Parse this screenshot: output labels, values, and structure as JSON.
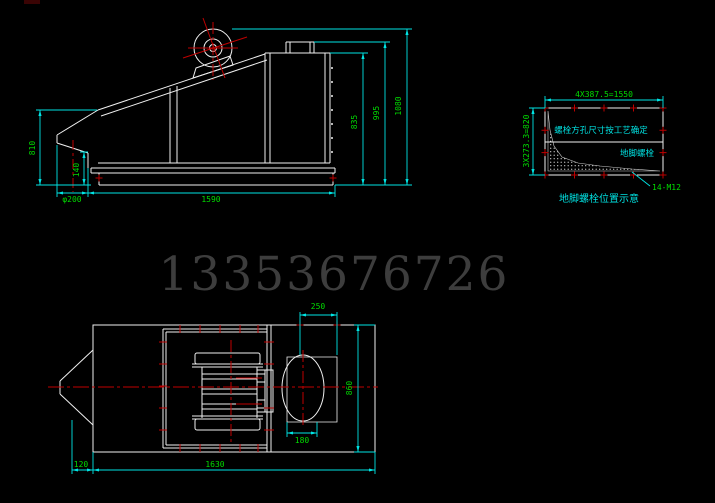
{
  "colors": {
    "background": "#000000",
    "line_white": "#f0f0f0",
    "centerline_red": "#c00000",
    "dimension_cyan": "#00e5e5",
    "dimension_text_green": "#00dd00",
    "note_text_cyan": "#00e0e0",
    "watermark_gray": "#3d3d3d"
  },
  "watermark": {
    "text": "13353676726"
  },
  "side_view": {
    "dims": {
      "left_height": "810",
      "outlet_drop": "140",
      "outlet_dia": "φ200",
      "base_length": "1590",
      "screen_height": "835",
      "inlet_height": "995",
      "total_height": "1080"
    }
  },
  "bolt_detail": {
    "dim_horizontal": "4X387.5=1550",
    "dim_vertical": "3X273.3=820",
    "bolt_spec": "14-M12",
    "note": "螺栓方孔尺寸按工艺确定",
    "label": "地脚螺栓",
    "caption": "地脚螺栓位置示意"
  },
  "plan_view": {
    "dims": {
      "outlet_offset": "250",
      "body_width": "860",
      "outlet_width": "180",
      "body_length": "1630",
      "tip_offset": "120"
    }
  }
}
